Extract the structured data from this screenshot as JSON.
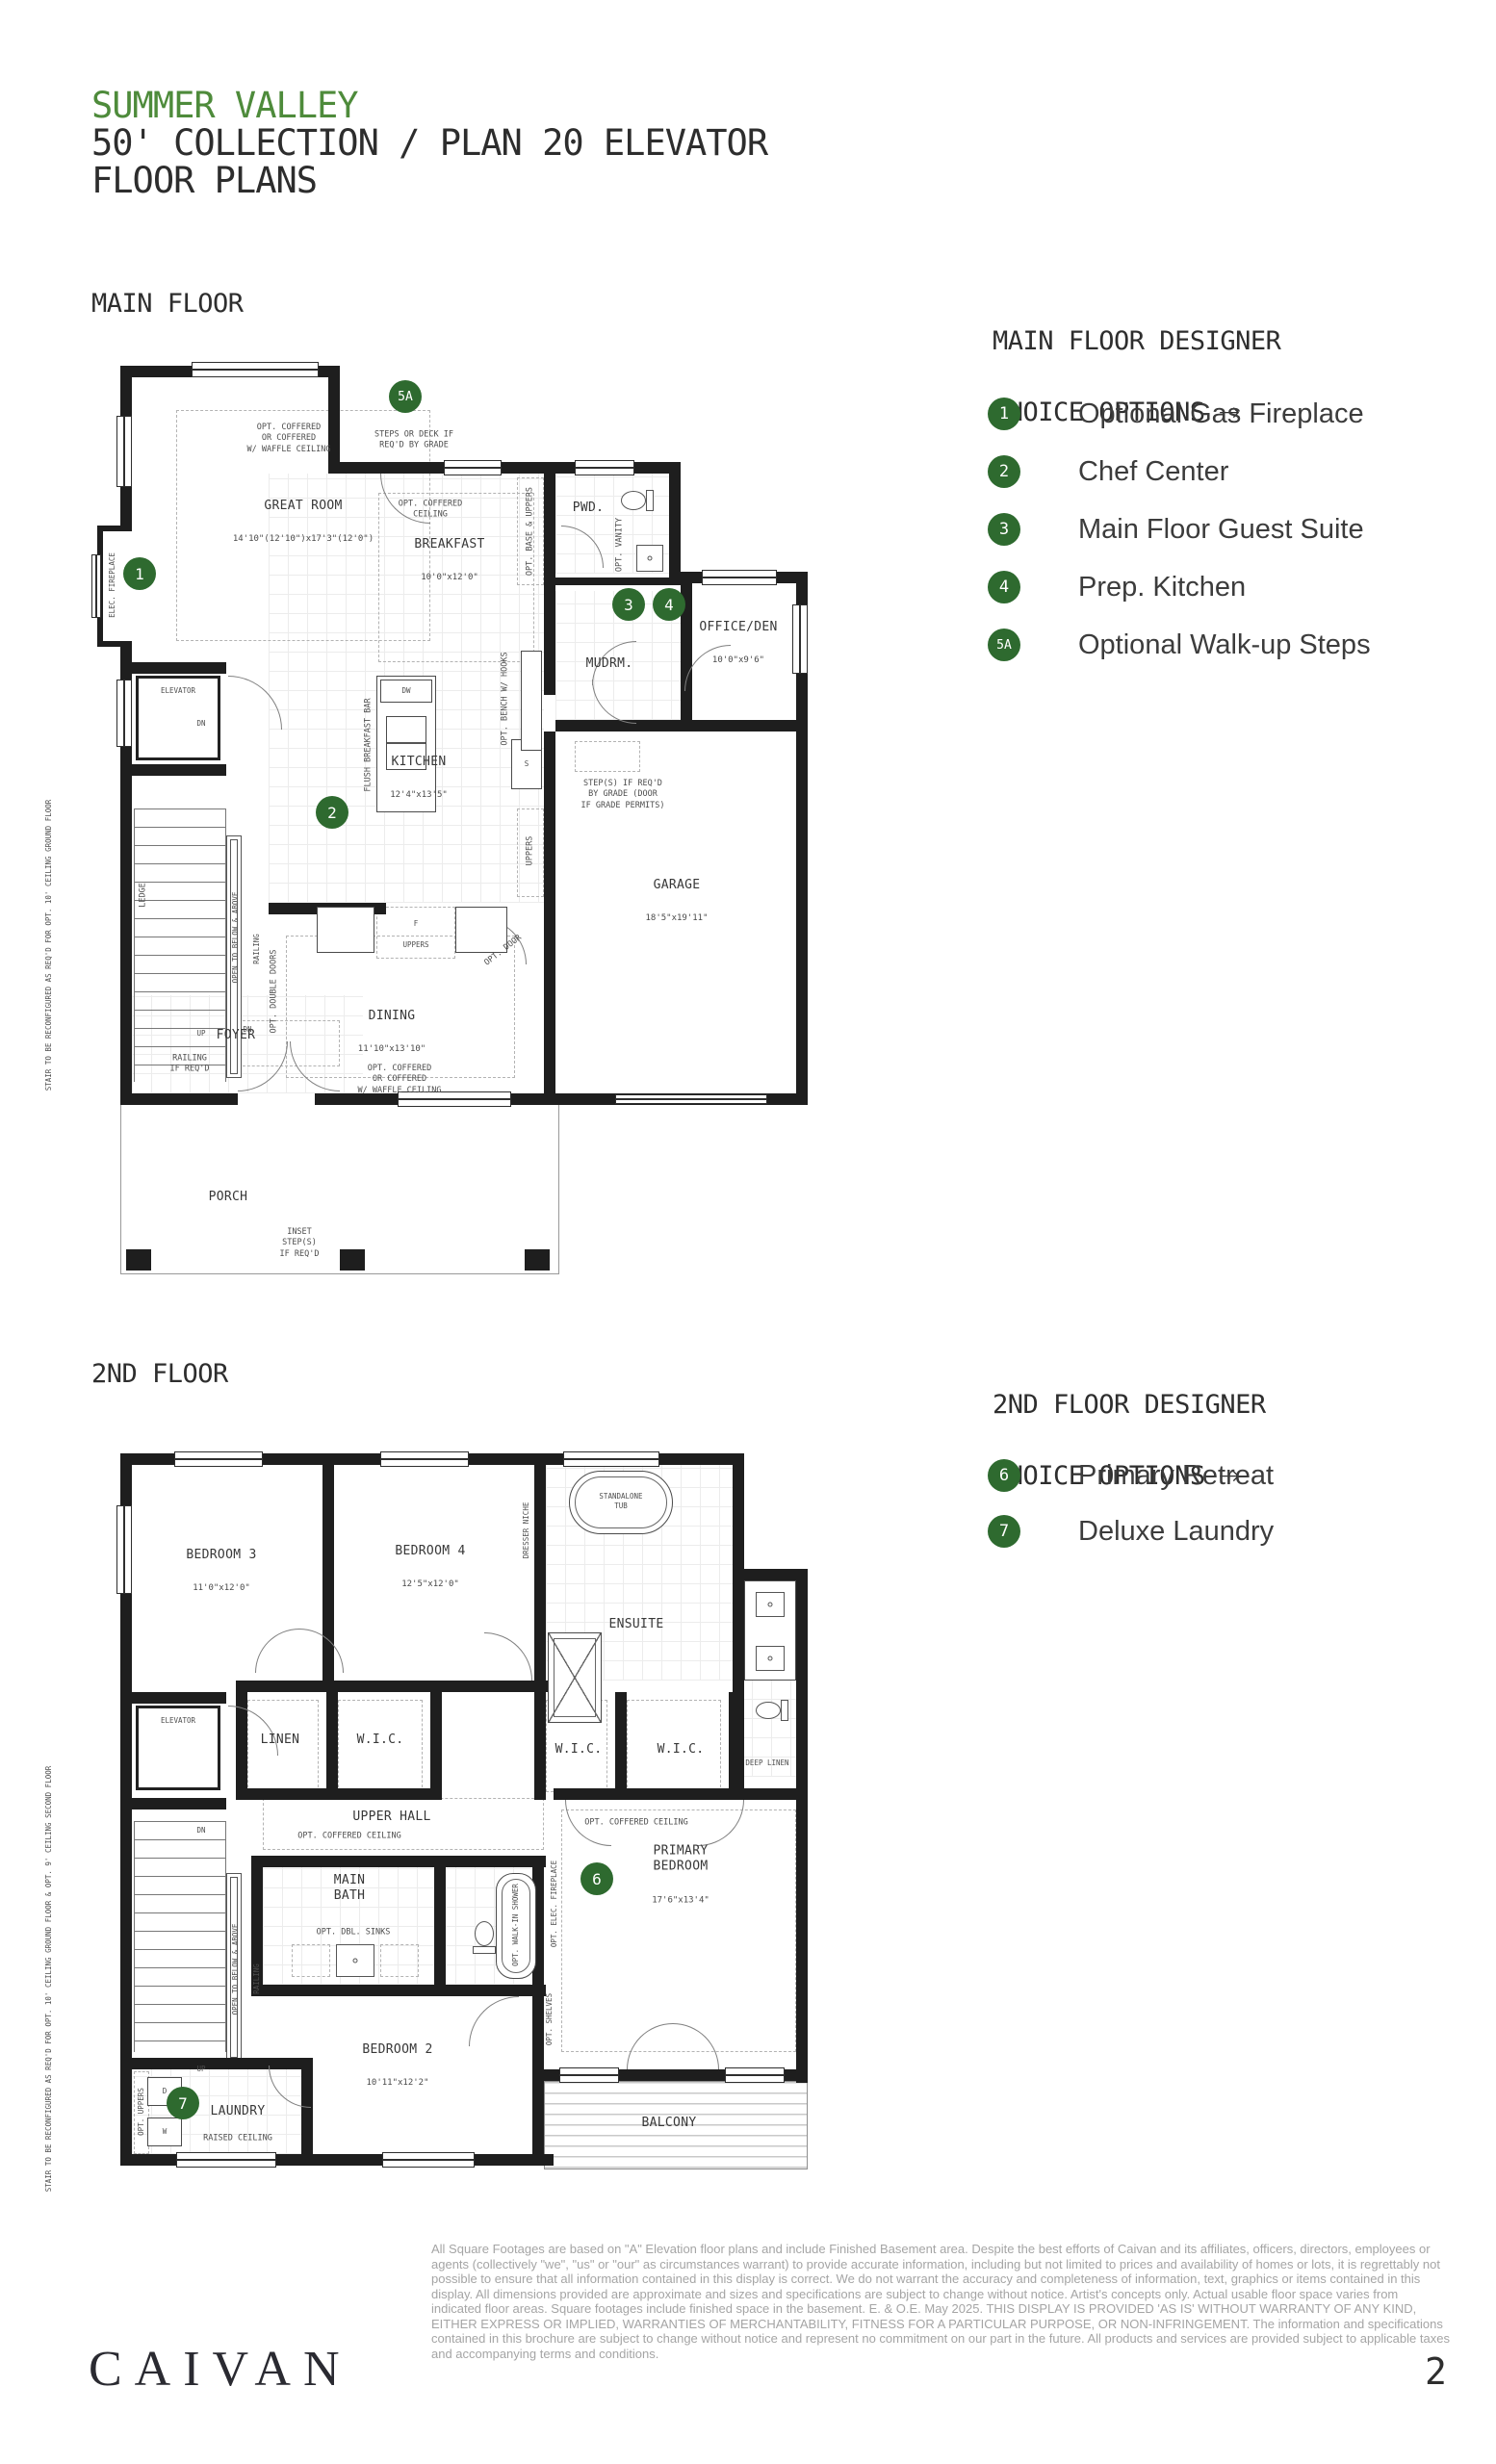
{
  "header": {
    "line1": "SUMMER VALLEY",
    "line2": "50' COLLECTION / PLAN 20 ELEVATOR",
    "line3": "FLOOR PLANS"
  },
  "arrow": "→",
  "accent_green": "#4e8b3b",
  "marker_green": "#2e6a2f",
  "mf": {
    "heading": "MAIN FLOOR",
    "opts_title1": "MAIN FLOOR DESIGNER",
    "opts_title2": "CHOICE OPTIONS",
    "options": [
      {
        "num": "1",
        "label": "Optional Gas Fireplace"
      },
      {
        "num": "2",
        "label": "Chef Center"
      },
      {
        "num": "3",
        "label": "Main Floor Guest Suite"
      },
      {
        "num": "4",
        "label": "Prep. Kitchen"
      },
      {
        "num": "5A",
        "label": "Optional Walk-up Steps"
      }
    ],
    "rooms": {
      "great": {
        "name": "GREAT ROOM",
        "dims": "14'10\"(12'10\")x17'3\"(12'0\")"
      },
      "breakfast": {
        "name": "BREAKFAST",
        "dims": "10'0\"x12'0\""
      },
      "kitchen": {
        "name": "KITCHEN",
        "dims": "12'4\"x13'5\""
      },
      "office": {
        "name": "OFFICE/DEN",
        "dims": "10'0\"x9'6\""
      },
      "pwd": {
        "name": "PWD."
      },
      "mudrm": {
        "name": "MUDRM."
      },
      "garage": {
        "name": "GARAGE",
        "dims": "18'5\"x19'11\""
      },
      "dining": {
        "name": "DINING",
        "dims": "11'10\"x13'10\""
      },
      "foyer": {
        "name": "FOYER"
      },
      "porch": {
        "name": "PORCH"
      },
      "elevator": {
        "name": "ELEVATOR"
      }
    },
    "markers": {
      "m1": "1",
      "m2": "2",
      "m3": "3",
      "m4": "4",
      "m5a": "5A"
    },
    "ann": {
      "great_ceiling": "OPT. COFFERED\nOR COFFERED\nW/ WAFFLE CEILING",
      "steps_deck": "STEPS OR DECK IF\nREQ'D BY GRADE",
      "brk_ceiling": "OPT. COFFERED\nCEILING",
      "base_uppers": "OPT. BASE & UPPERS",
      "vanity": "OPT. VANITY",
      "uppers": "UPPERS",
      "flush_bar": "FLUSH BREAKFAST BAR",
      "dw": "DW",
      "s": "S",
      "f": "F",
      "bench": "OPT. BENCH\nW/ HOOKS",
      "dn": "DN",
      "up": "UP",
      "elec_fp": "ELEC. FIREPLACE",
      "ledge": "LEDGE",
      "open_below": "OPEN TO BELOW & ABOVE",
      "railing": "RAILING",
      "stair_note": "STAIR TO BE RECONFIGURED\nAS REQ'D FOR OPT. 10' CEILING\nGROUND FLOOR",
      "railing_req": "RAILING\nIF REQ'D",
      "dbl_doors": "OPT. DOUBLE DOORS",
      "steps_grade": "STEP(S) IF REQ'D\nBY GRADE (DOOR\nIF GRADE PERMITS)",
      "dining_ceiling": "OPT. COFFERED\nOR COFFERED\nW/ WAFFLE CEILING",
      "inset_steps": "INSET\nSTEP(S)\nIF REQ'D",
      "opt_door": "OPT. DOOR"
    }
  },
  "sf": {
    "heading": "2ND FLOOR",
    "opts_title1": "2ND FLOOR DESIGNER",
    "opts_title2": "CHOICE OPTIONS",
    "options": [
      {
        "num": "6",
        "label": "Primary Retreat"
      },
      {
        "num": "7",
        "label": "Deluxe Laundry"
      }
    ],
    "rooms": {
      "bed3": {
        "name": "BEDROOM 3",
        "dims": "11'0\"x12'0\""
      },
      "bed4": {
        "name": "BEDROOM 4",
        "dims": "12'5\"x12'0\""
      },
      "ensuite": {
        "name": "ENSUITE"
      },
      "linen": {
        "name": "LINEN"
      },
      "wic1": {
        "name": "W.I.C."
      },
      "wic2": {
        "name": "W.I.C."
      },
      "wic3": {
        "name": "W.I.C."
      },
      "deep_linen": {
        "name": "DEEP LINEN"
      },
      "hall": {
        "name": "UPPER HALL"
      },
      "bath": {
        "name": "MAIN\nBATH"
      },
      "primary": {
        "name": "PRIMARY\nBEDROOM",
        "dims": "17'6\"x13'4\""
      },
      "bed2": {
        "name": "BEDROOM 2",
        "dims": "10'11\"x12'2\""
      },
      "laundry": {
        "name": "LAUNDRY"
      },
      "balcony": {
        "name": "BALCONY"
      },
      "elevator": {
        "name": "ELEVATOR"
      }
    },
    "markers": {
      "m6": "6",
      "m7": "7"
    },
    "ann": {
      "tub": "STANDALONE\nTUB",
      "dresser": "DRESSER NICHE",
      "hall_ceiling": "OPT. COFFERED CEILING",
      "primary_ceiling": "OPT. COFFERED CEILING",
      "dbl_sinks": "OPT. DBL. SINKS",
      "walkin": "OPT. WALK-IN\nSHOWER",
      "elec_fp": "OPT. ELEC. FIREPLACE",
      "shelves": "OPT.\nSHELVES",
      "raised": "RAISED CEILING",
      "opt_uppers": "OPT. UPPERS",
      "d": "D",
      "w": "W",
      "dn": "DN",
      "up": "UP",
      "open_below": "OPEN TO BELOW & ABOVE",
      "railing": "RAILING",
      "stair_note": "STAIR TO BE RECONFIGURED AS REQ'D\nFOR OPT. 10' CEILING GROUND FLOOR &\nOPT. 9' CEILING SECOND FLOOR"
    }
  },
  "footer": {
    "brand": "CAIVAN",
    "page": "2",
    "disclaimer": "All Square Footages are based on \"A\" Elevation floor plans and include Finished Basement area. Despite the best efforts of Caivan and its affiliates, officers, directors, employees or agents (collectively \"we\", \"us\" or \"our\" as circumstances warrant) to provide accurate information, including but not limited to prices and availability of homes or lots, it is regrettably not possible to ensure that all information contained in this display is correct. We do not warrant the accuracy and completeness of information, text, graphics or items contained in this display. All dimensions provided are approximate and sizes and specifications are subject to change without notice. Artist's concepts only. Actual usable floor space varies from indicated floor areas. Square footages include finished space in the basement. E. & O.E. May 2025. THIS DISPLAY IS PROVIDED 'AS IS' WITHOUT WARRANTY OF ANY KIND, EITHER EXPRESS OR IMPLIED, WARRANTIES OF MERCHANTABILITY, FITNESS FOR A PARTICULAR PURPOSE, OR NON-INFRINGEMENT. The information and specifications contained in this brochure are subject to change without notice and represent no commitment on our part in the future. All products and services are provided subject to applicable taxes and accompanying terms and conditions."
  }
}
